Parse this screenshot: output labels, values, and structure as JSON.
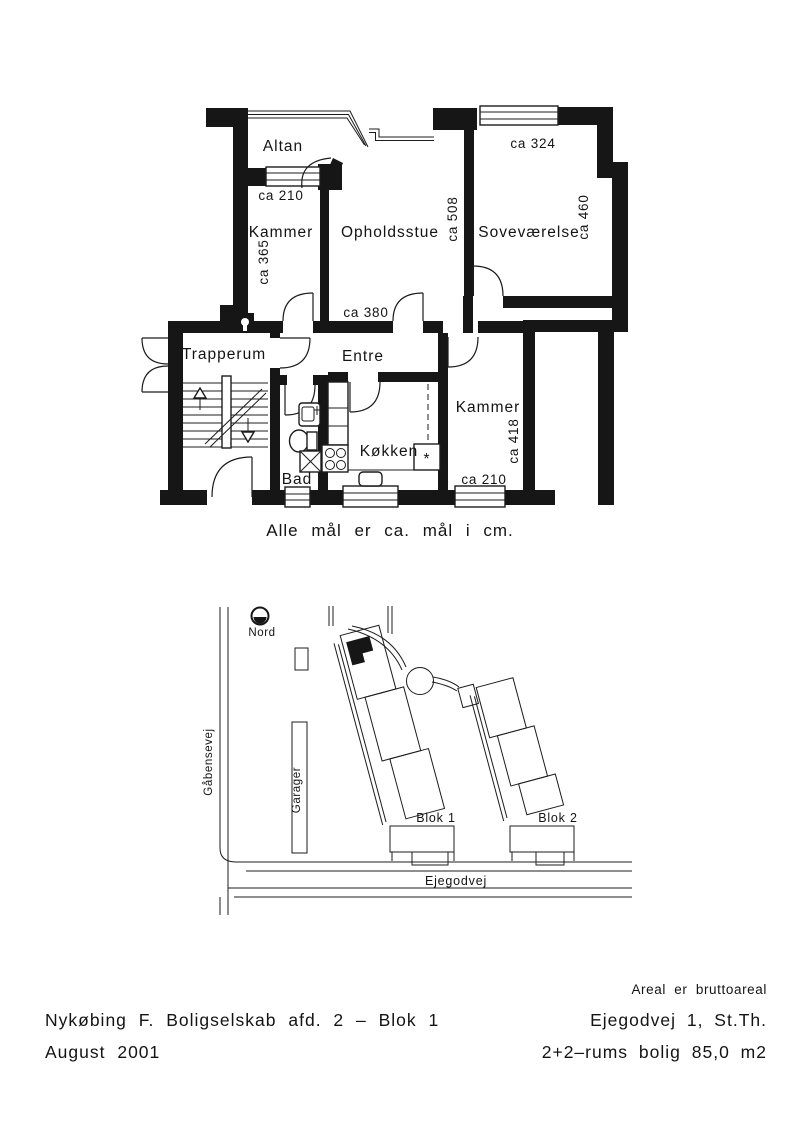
{
  "floor_plan": {
    "rooms": {
      "altan": "Altan",
      "kammer_upper": "Kammer",
      "opholdsstue": "Opholdsstue",
      "sovevaerelse": "Soveværelse",
      "trapperum": "Trapperum",
      "entre": "Entre",
      "bad": "Bad",
      "koekken": "Køkken",
      "kammer_lower": "Kammer"
    },
    "dimensions": {
      "kammer_upper_width": "ca 210",
      "kammer_upper_depth": "ca 365",
      "opholdsstue_depth": "ca 508",
      "opholdsstue_width": "ca 380",
      "sovevaerelse_width": "ca 324",
      "sovevaerelse_depth": "ca 460",
      "kammer_lower_depth": "ca 418",
      "kammer_lower_width": "ca 210"
    },
    "fridge_symbol": "*",
    "note": "Alle mål er ca. mål i cm."
  },
  "site_plan": {
    "compass_label": "Nord",
    "street_west": "Gåbensevej",
    "street_south": "Ejegodvej",
    "garages_label": "Garager",
    "blok1_label": "Blok 1",
    "blok2_label": "Blok 2"
  },
  "footer": {
    "project": "Nykøbing F. Boligselskab afd. 2 – Blok 1",
    "date": "August 2001",
    "area_note": "Areal er bruttoareal",
    "address": "Ejegodvej 1, St.Th.",
    "layout": "2+2–rums bolig 85,0 m2"
  },
  "colors": {
    "ink": "#161616",
    "paper": "#ffffff"
  }
}
